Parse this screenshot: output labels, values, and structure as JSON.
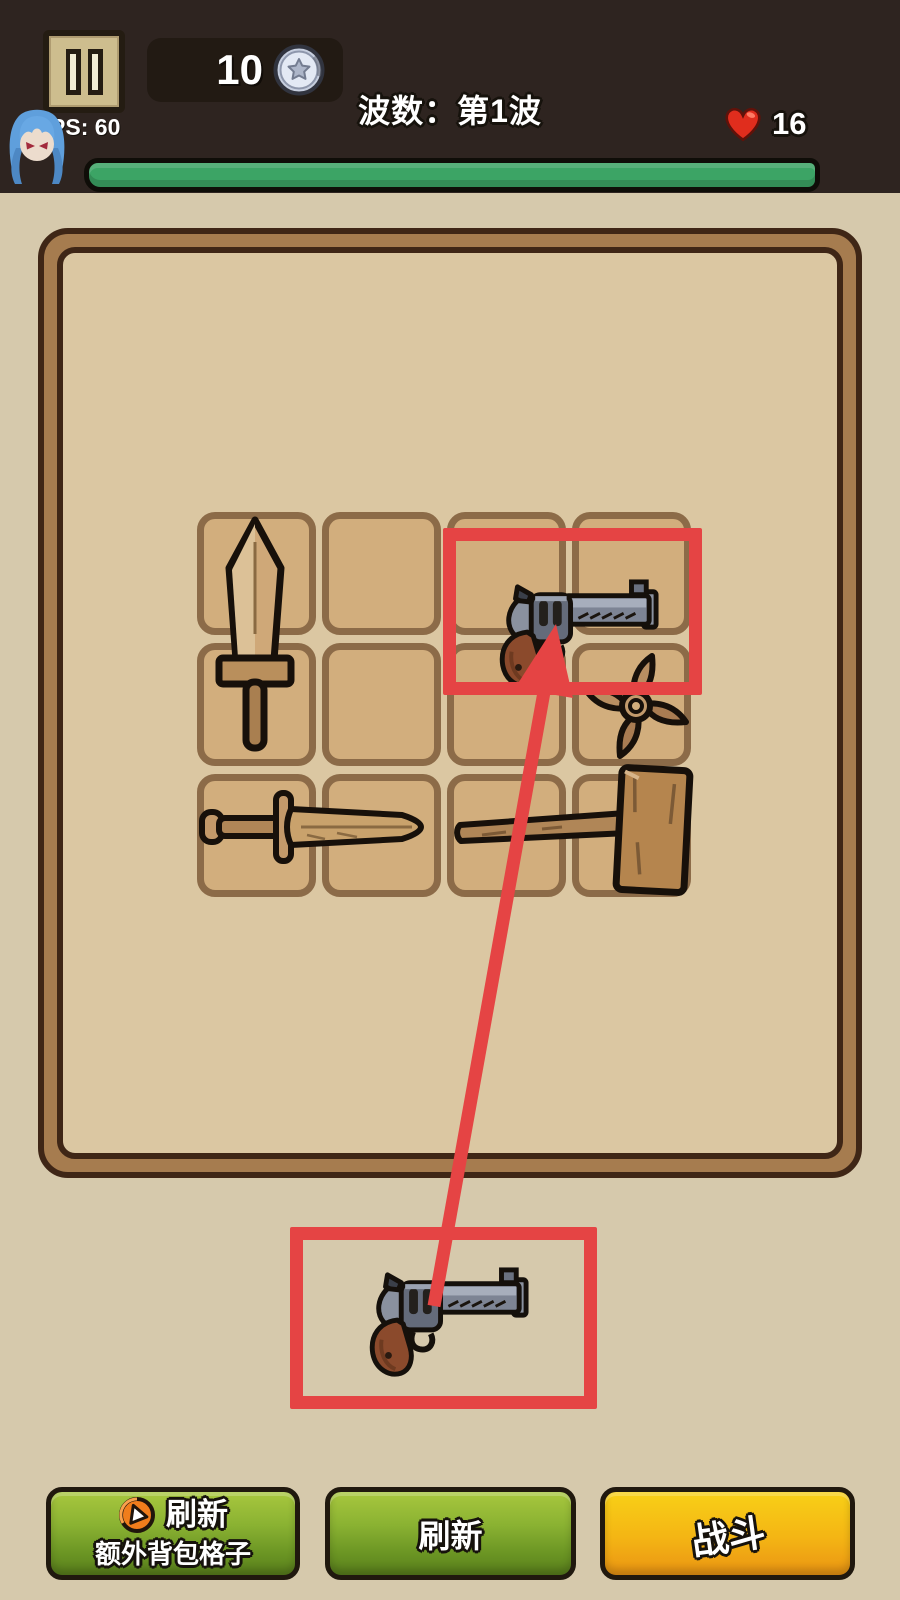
{
  "hud": {
    "coins": "10",
    "coin_icon": "silver-star-coin",
    "wave_label": "波数：第1波",
    "fps_label": "FPS: 60",
    "lives": "16",
    "life_icon": "red-heart",
    "health_bar": {
      "value": "full",
      "color": "#3ca465"
    },
    "avatar": "blue-haired-character"
  },
  "board": {
    "grid": {
      "cols": 4,
      "rows": 3
    },
    "items": [
      {
        "name": "wooden-sword",
        "col": 1,
        "row": 1,
        "col_span": 1,
        "row_span": 2
      },
      {
        "name": "revolver",
        "col": 3,
        "row": 1,
        "col_span": 2,
        "row_span": 1
      },
      {
        "name": "shuriken",
        "col": 4,
        "row": 2,
        "col_span": 1,
        "row_span": 1
      },
      {
        "name": "wooden-dagger",
        "col": 1,
        "row": 3,
        "col_span": 2,
        "row_span": 1
      },
      {
        "name": "wooden-hammer",
        "col": 3,
        "row": 3,
        "col_span": 2,
        "row_span": 1
      }
    ]
  },
  "tutorial": {
    "source_item": "revolver",
    "target_slot": "row1-col3-col4",
    "highlight_color": "#e54444",
    "gesture": "drag-arrow-from-source-to-target"
  },
  "buttons": {
    "refresh_extra": {
      "line1": "刷新",
      "line2": "额外背包格子",
      "icon": "orange-play-circle"
    },
    "refresh": {
      "label": "刷新"
    },
    "battle": {
      "label": "战斗"
    }
  },
  "colors": {
    "topbar_bg": "#2e2420",
    "page_bg": "#d6c9ac",
    "panel_fill": "#dbc7a2",
    "panel_band": "#a67c4f",
    "cell_fill": "#d2ae7d",
    "cell_border": "#8c6b48",
    "accent_red": "#e54444",
    "button_green_top": "#a8c73e",
    "button_green_bottom": "#597f1c",
    "button_orange_top": "#f8d017",
    "button_orange_bottom": "#ea9413"
  }
}
